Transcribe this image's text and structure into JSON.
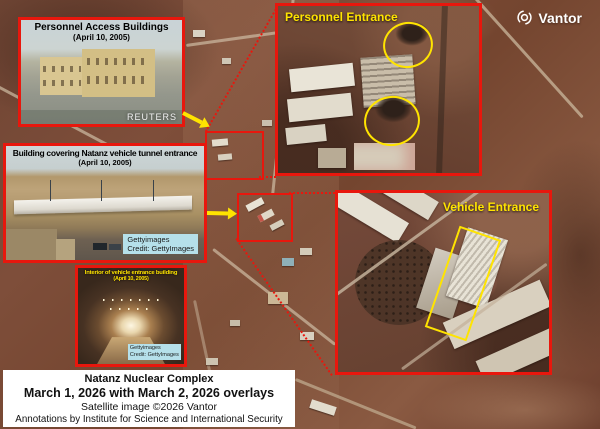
{
  "watermark": {
    "brand": "Vantor",
    "icon": "vantor-aperture-icon"
  },
  "insets": {
    "personnel_access": {
      "title": "Personnel Access Buildings",
      "date": "(April 10, 2005)",
      "credit": "REUTERS"
    },
    "tunnel_building": {
      "title": "Building covering Natanz vehicle tunnel entrance",
      "date": "(April 10, 2005)",
      "credit1": "Gettyimages",
      "credit2": "Credit: GettyImages"
    },
    "tunnel_interior": {
      "title": "Interior of vehicle entrance building",
      "date": "(April 10, 2005)",
      "credit1": "Gettyimages",
      "credit2": "Credit: GettyImages"
    },
    "personnel_entrance_label": "Personnel Entrance",
    "vehicle_entrance_label": "Vehicle Entrance"
  },
  "caption": {
    "site": "Natanz Nuclear Complex",
    "dates": "March 1, 2026 with March 2, 2026 overlays",
    "source": "Satellite image ©2026 Vantor",
    "annotations": "Annotations by Institute for Science and International Security"
  },
  "colors": {
    "annotation_red": "#e8170d",
    "highlight_yellow": "#ffe400",
    "credit_bg": "#b5e0ea",
    "terrain_brown": "#74452f"
  }
}
